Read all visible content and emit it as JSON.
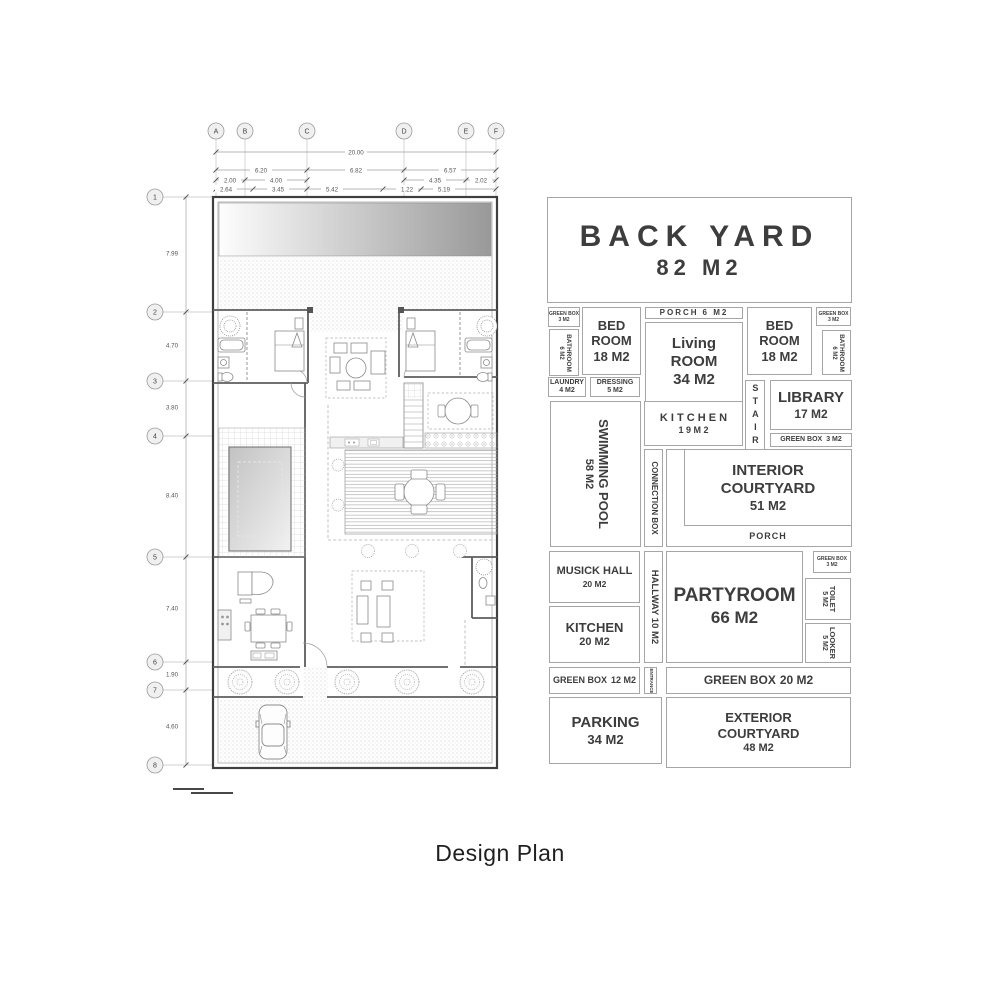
{
  "page": {
    "title": "Design Plan"
  },
  "plan": {
    "grid_cols": [
      "A",
      "B",
      "C",
      "D",
      "E",
      "F"
    ],
    "grid_rows": [
      "1",
      "2",
      "3",
      "4",
      "5",
      "6",
      "7",
      "8"
    ],
    "dim_total": "20.00",
    "dims_row2": [
      "6.20",
      "6.82",
      "6.57"
    ],
    "dims_row3": [
      "2.00",
      "4.00",
      "4.35",
      "2.02"
    ],
    "dims_row4": [
      "2.64",
      "3.45",
      "5.42",
      "1.22",
      "5.19"
    ],
    "dims_left": [
      "7.99",
      "4.70",
      "3.80",
      "8.40",
      "7.40",
      "1.90",
      "4.60"
    ]
  },
  "diagram": {
    "back_yard": {
      "name": "BACK YARD",
      "area": "82 M2"
    },
    "green_box_tl": {
      "name": "GREEN BOX",
      "area": "3 M2"
    },
    "bed_left": {
      "name": "BED ROOM",
      "area": "18 M2"
    },
    "porch_top": {
      "name": "PORCH",
      "area": "6 M2"
    },
    "living": {
      "name": "Living ROOM",
      "area": "34 M2"
    },
    "bed_right": {
      "name": "BED ROOM",
      "area": "18 M2"
    },
    "green_box_tr": {
      "name": "GREEN BOX",
      "area": "3 M2"
    },
    "bathroom_left": {
      "name": "BATHROOM",
      "area": "6 M2"
    },
    "bathroom_right": {
      "name": "BATHROOM",
      "area": "6 M2"
    },
    "laundry": {
      "name": "LAUNDRY",
      "area": "4 M2"
    },
    "dressing": {
      "name": "DRESSING",
      "area": "5 M2"
    },
    "stair": {
      "name": "STAIR"
    },
    "library": {
      "name": "LIBRARY",
      "area": "17 M2"
    },
    "green_box_lib": {
      "name": "GREEN BOX",
      "area": "3 M2"
    },
    "swimming_pool": {
      "name": "SWIMMING POOL",
      "area": "58 M2"
    },
    "kitchen_up": {
      "name": "K I T C H E N",
      "area": "1 9   M 2"
    },
    "connection_box": {
      "name": "CONNECTION BOX"
    },
    "interior_courtyard": {
      "name": "INTERIOR COURTYARD",
      "area": "51 M2"
    },
    "porch_mid": {
      "name": "PORCH"
    },
    "musick_hall": {
      "name": "MUSICK HALL",
      "area": "20 M2"
    },
    "hallway": {
      "name": "HALLWAY 10 M2"
    },
    "partyroom": {
      "name": "PARTYROOM",
      "area": "66 M2"
    },
    "green_box_pr": {
      "name": "GREEN BOX",
      "area": "3 M2"
    },
    "toilet": {
      "name": "TOILET",
      "area": "5 M2"
    },
    "looker": {
      "name": "LOOKER",
      "area": "5 M2"
    },
    "kitchen_low": {
      "name": "KITCHEN",
      "area": "20 M2"
    },
    "green_box_12": {
      "name": "GREEN BOX",
      "area": "12 M2"
    },
    "entrance": {
      "name": "ENTRANCE"
    },
    "green_box_20": {
      "name": "GREEN BOX",
      "area": "20 M2"
    },
    "parking": {
      "name": "PARKING",
      "area": "34 M2"
    },
    "exterior_courtyard": {
      "name": "EXTERIOR COURTYARD",
      "area": "48 M2"
    }
  }
}
